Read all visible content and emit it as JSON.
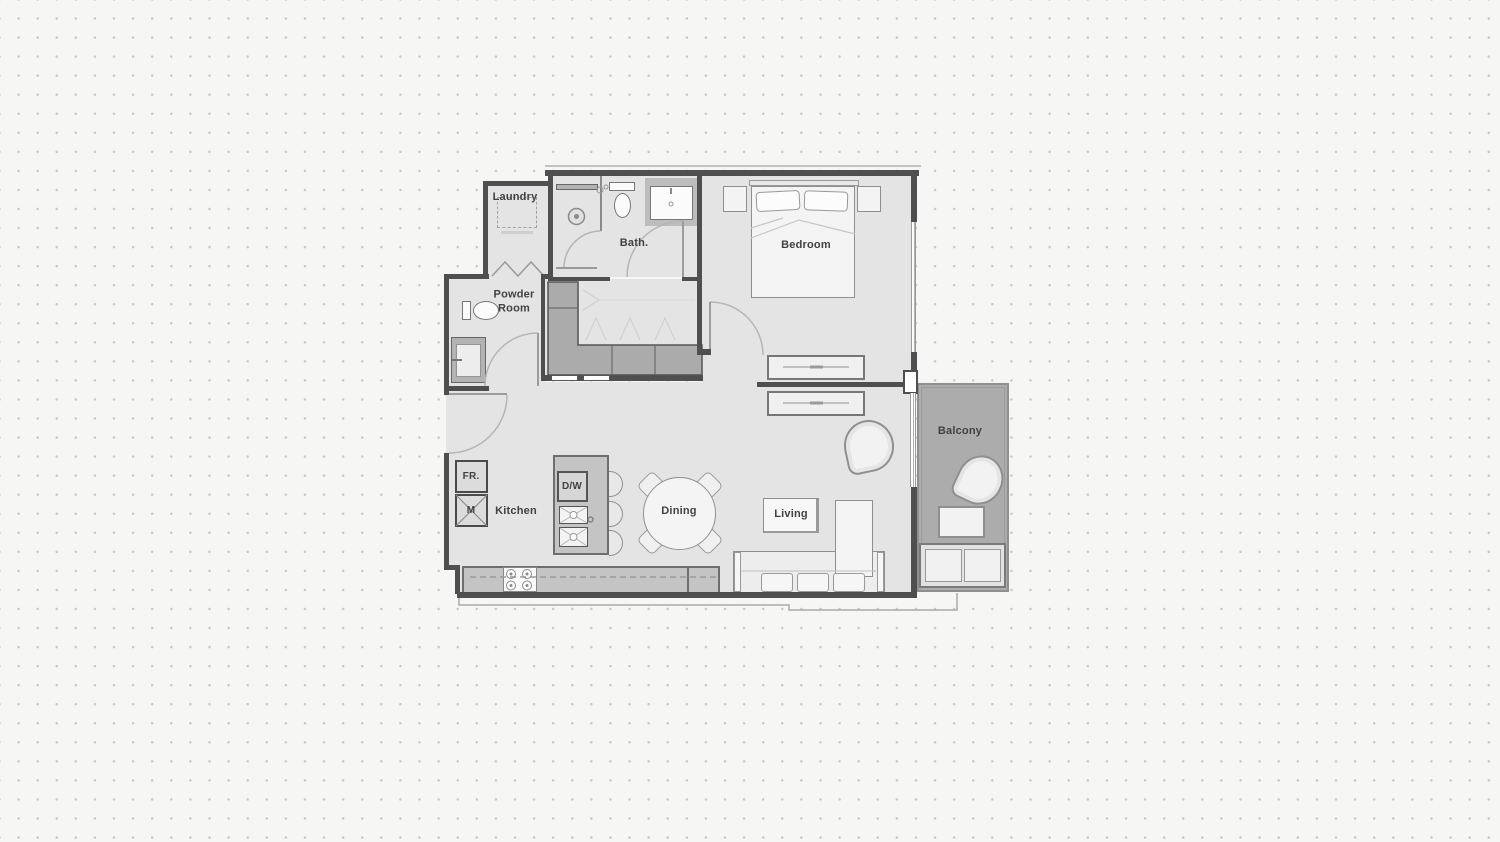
{
  "floorplan": {
    "title": "one-bedroom-apartment-floor-plan",
    "labels": {
      "laundry": "Laundry",
      "bath": "Bath.",
      "bedroom": "Bedroom",
      "powder_room": "Powder Room",
      "kitchen": "Kitchen",
      "dining": "Dining",
      "living": "Living",
      "balcony": "Balcony"
    },
    "appliances": {
      "fridge": "FR.",
      "microwave": "M",
      "dishwasher": "D/W"
    },
    "colors": {
      "page_background": "#f6f6f5",
      "dot_grid": "#c8c8c8",
      "wall": "#4f4f4f",
      "floor": "#e4e4e4",
      "balcony_floor": "#acacac",
      "cabinet": "#ababab",
      "counter": "#c4c4c4",
      "furniture_fill": "#f3f3f3",
      "label_text": "#414141"
    }
  }
}
